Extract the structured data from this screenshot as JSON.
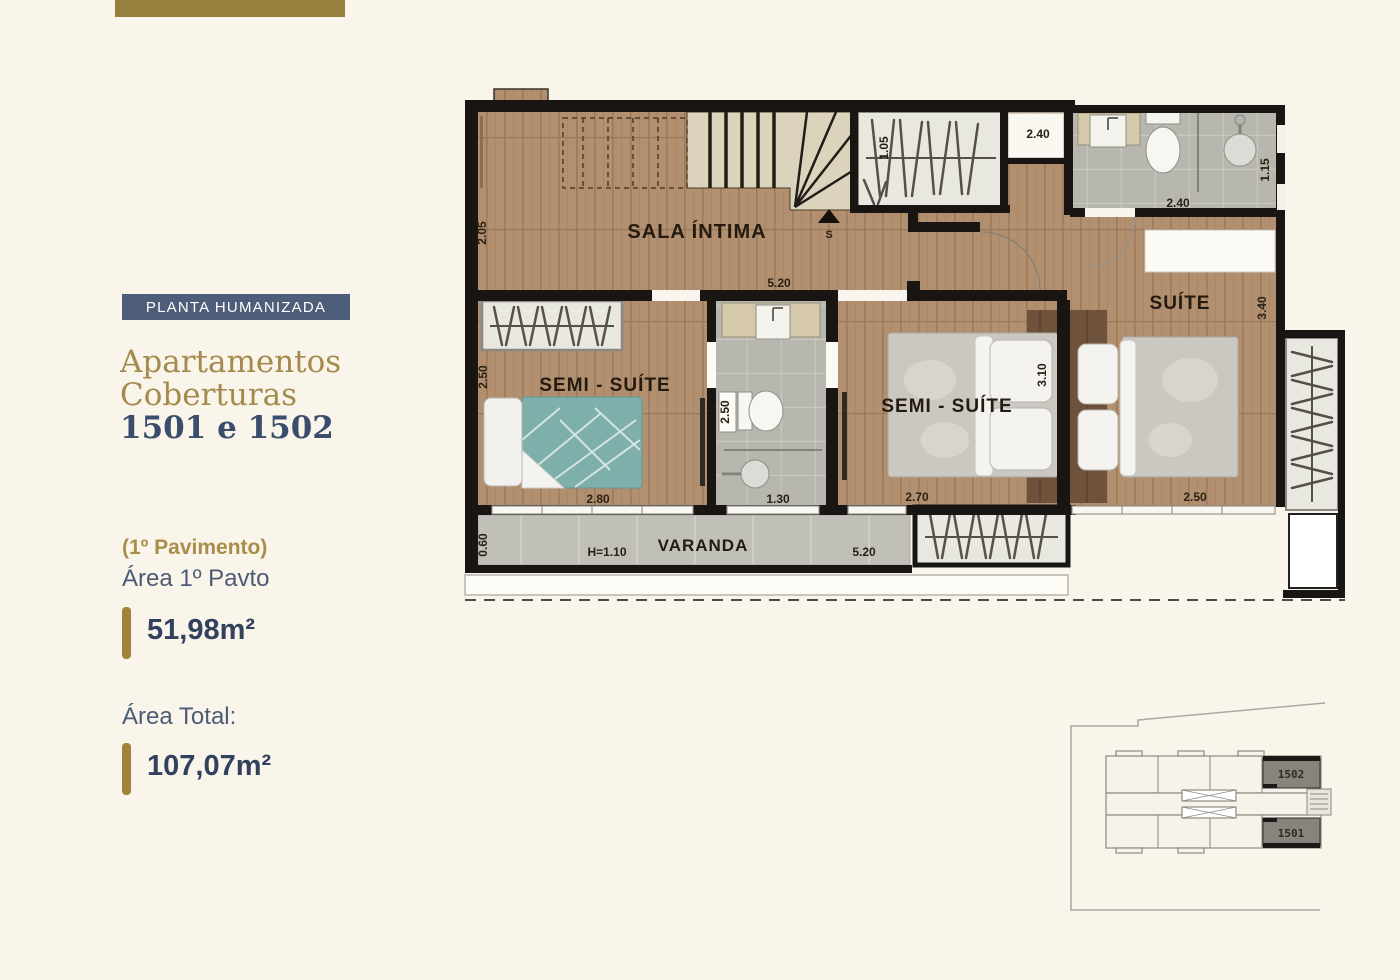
{
  "page": {
    "background": "#faf5ea"
  },
  "sidebar": {
    "badge": {
      "label": "PLANTA HUMANIZADA",
      "bg": "#4e5d79",
      "text_color": "#ffffff"
    },
    "title_line1": "Apartamentos",
    "title_line2": "Coberturas",
    "title_line3": "1501 e 1502",
    "pavement_note": "(1º Pavimento)",
    "area_pavto_label": "Área 1º Pavto",
    "area_pavto_value": "51,98m²",
    "area_total_label": "Área Total:",
    "area_total_value": "107,07m²",
    "accent_gold": "#a1843c",
    "navy": "#3b4d6c"
  },
  "floorplan": {
    "rooms": {
      "sala_intima": "SALA ÍNTIMA",
      "semi_suite_1": "SEMI - SUÍTE",
      "semi_suite_2": "SEMI - SUÍTE",
      "suite": "SUÍTE",
      "varanda": "VARANDA",
      "stairs_direction": "S"
    },
    "dims": {
      "sala_left": "2.05",
      "sala_width": "5.20",
      "closet_top": "1.05",
      "niche_top": "2.40",
      "bath_top_width": "2.40",
      "bath_top_height": "1.15",
      "suite_height": "3.40",
      "semi1_height": "2.50",
      "bath_mid_height": "2.50",
      "semi2_bed": "3.10",
      "semi1_width": "2.80",
      "bath_mid_width": "1.30",
      "semi2_width": "2.70",
      "suite_width": "2.50",
      "varanda_depth": "0.60",
      "varanda_rail": "H=1.10",
      "varanda_width": "5.20"
    }
  },
  "keyplan": {
    "unit_top": "1502",
    "unit_bottom": "1501"
  }
}
